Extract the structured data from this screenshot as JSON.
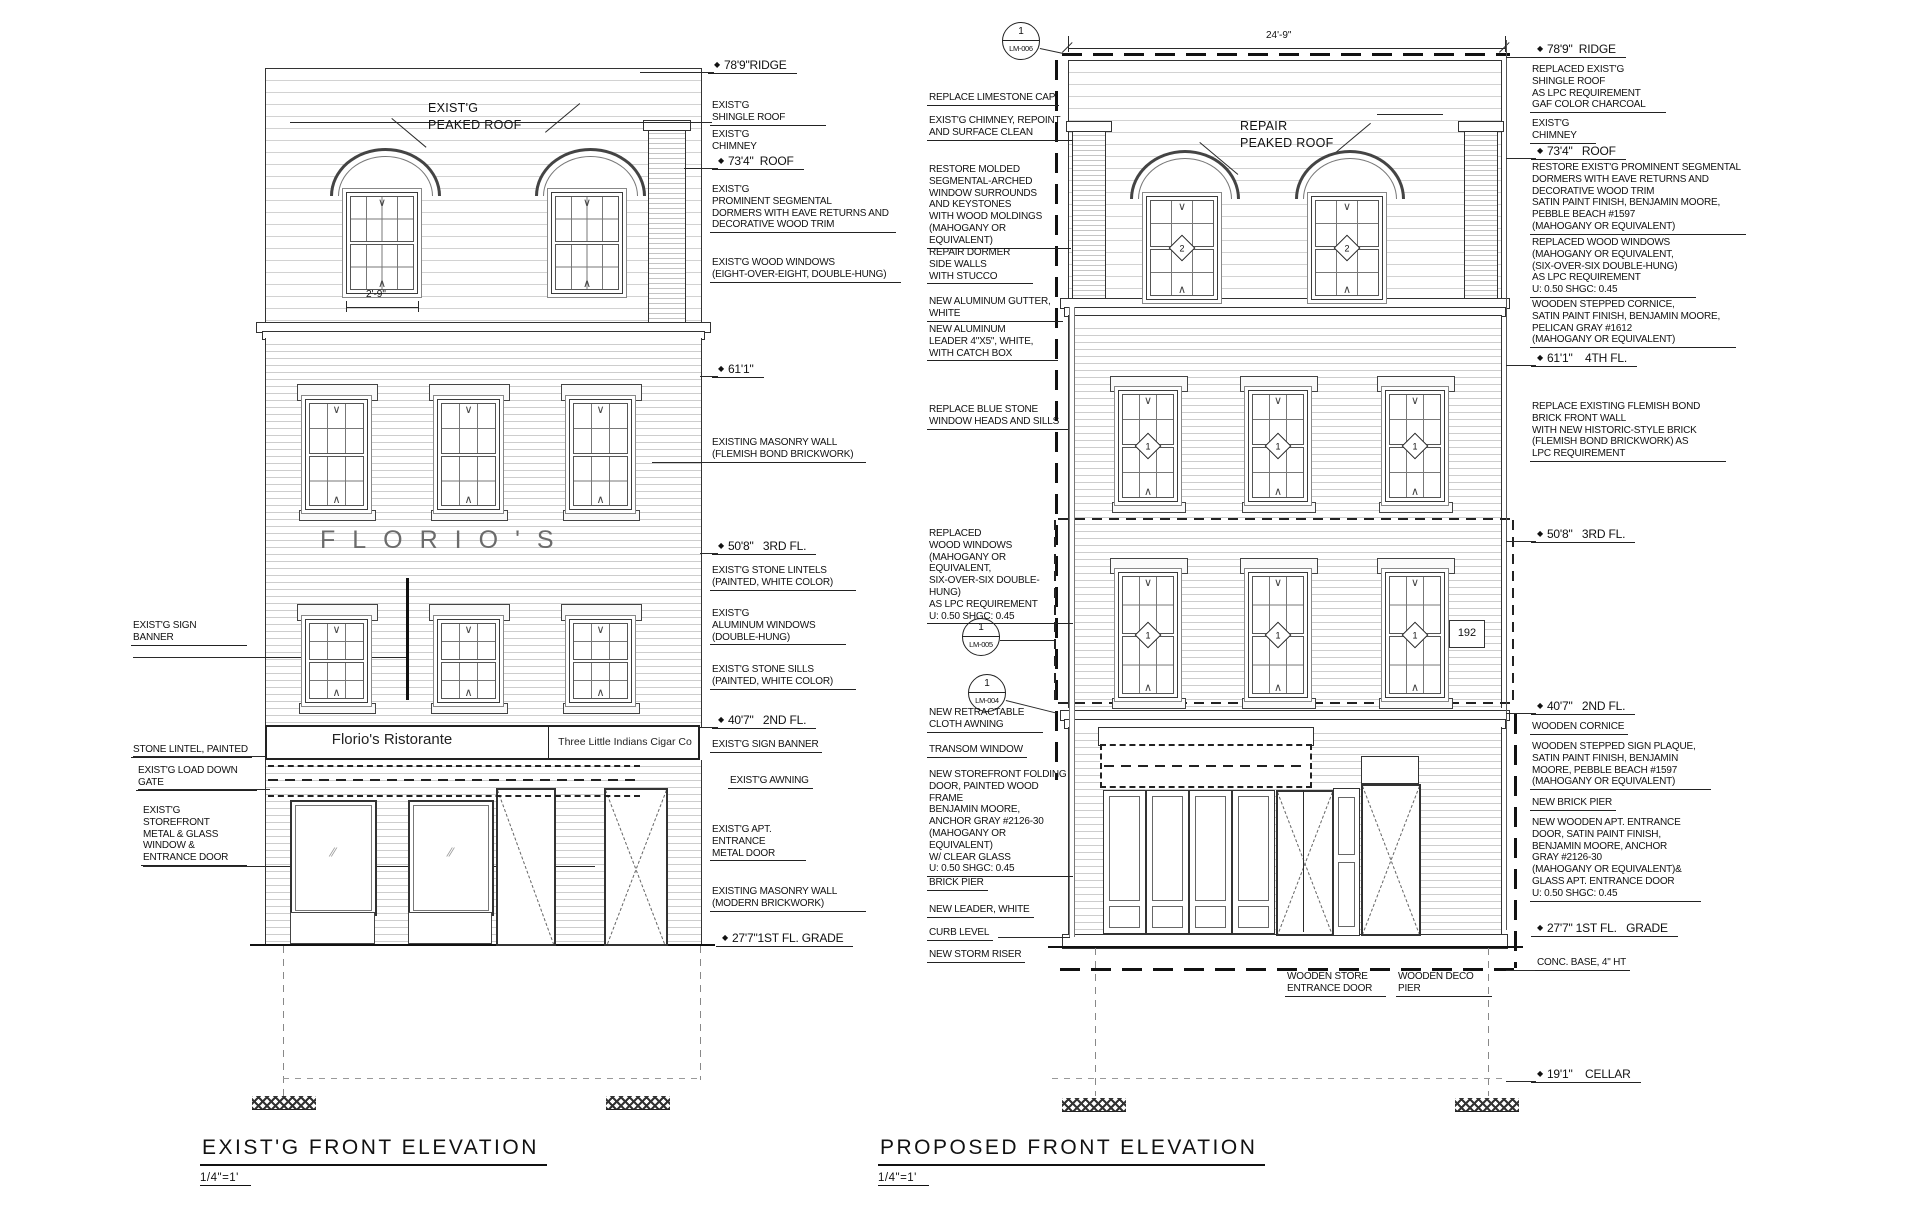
{
  "existing": {
    "title": "EXIST'G FRONT ELEVATION",
    "scale": "1/4\"=1'",
    "roof_label": "EXIST'G\nPEAKED ROOF",
    "dormer_dim": "2'-9\"",
    "facade_name": "FLORIO'S",
    "sign_left": "Florio's Ristorante",
    "sign_right": "Three Little Indians Cigar Co"
  },
  "proposed": {
    "title": "PROPOSED FRONT ELEVATION",
    "scale": "1/4\"=1'",
    "roof_label": "REPAIR\nPEAKED ROOF",
    "width_dim": "24'-9\"",
    "address": "192",
    "window_tags": {
      "dormer": "2",
      "floor": "1"
    },
    "detail_markers": [
      {
        "num": "1",
        "ref": "LM-006"
      },
      {
        "num": "1",
        "ref": "LM-005"
      },
      {
        "num": "1",
        "ref": "LM-004"
      }
    ]
  },
  "annotations": [
    {
      "t": "78'9\"RIDGE",
      "x": 714,
      "y": 58,
      "cls": "dim ul"
    },
    {
      "t": "EXIST'G\nSHINGLE ROOF",
      "x": 712,
      "y": 100,
      "cls": "ul",
      "w": 110
    },
    {
      "t": "EXIST'G\nCHIMNEY",
      "x": 712,
      "y": 129,
      "cls": ""
    },
    {
      "t": "73'4\"  ROOF",
      "x": 718,
      "y": 154,
      "cls": "dim ul"
    },
    {
      "t": "EXIST'G\nPROMINENT SEGMENTAL\nDORMERS WITH EAVE RETURNS AND\nDECORATIVE WOOD TRIM",
      "x": 712,
      "y": 184,
      "cls": "ul",
      "w": 180
    },
    {
      "t": "EXIST'G WOOD WINDOWS\n(EIGHT-OVER-EIGHT, DOUBLE-HUNG)",
      "x": 712,
      "y": 257,
      "cls": "ul",
      "w": 185
    },
    {
      "t": "61'1\"",
      "x": 718,
      "y": 362,
      "cls": "dim ul"
    },
    {
      "t": "EXISTING MASONRY WALL\n(FLEMISH BOND BRICKWORK)",
      "x": 712,
      "y": 437,
      "cls": "ul",
      "w": 150
    },
    {
      "t": "50'8\"   3RD FL.",
      "x": 718,
      "y": 539,
      "cls": "dim ul"
    },
    {
      "t": "EXIST'G STONE LINTELS\n(PAINTED, WHITE COLOR)",
      "x": 712,
      "y": 565,
      "cls": "ul",
      "w": 140
    },
    {
      "t": "EXIST'G\nALUMINUM WINDOWS\n(DOUBLE-HUNG)",
      "x": 712,
      "y": 608,
      "cls": "ul",
      "w": 130
    },
    {
      "t": "EXIST'G STONE SILLS\n(PAINTED, WHITE COLOR)",
      "x": 712,
      "y": 664,
      "cls": "ul",
      "w": 140
    },
    {
      "t": "40'7\"   2ND FL.",
      "x": 718,
      "y": 713,
      "cls": "dim ul"
    },
    {
      "t": "EXIST'G SIGN BANNER",
      "x": 712,
      "y": 739,
      "cls": "ul"
    },
    {
      "t": "EXIST'G AWNING",
      "x": 730,
      "y": 775,
      "cls": "ul"
    },
    {
      "t": "EXIST'G APT.\nENTRANCE\nMETAL DOOR",
      "x": 712,
      "y": 824,
      "cls": "ul",
      "w": 90
    },
    {
      "t": "EXISTING MASONRY WALL\n(MODERN BRICKWORK)",
      "x": 712,
      "y": 886,
      "cls": "ul",
      "w": 150
    },
    {
      "t": "27'7\"1ST FL. GRADE",
      "x": 722,
      "y": 931,
      "cls": "dim ul"
    },
    {
      "t": "EXIST'G SIGN\nBANNER",
      "x": 133,
      "y": 620,
      "cls": "ul",
      "w": 110
    },
    {
      "t": "STONE LINTEL, PAINTED",
      "x": 133,
      "y": 744,
      "cls": "ul"
    },
    {
      "t": "EXIST'G LOAD DOWN\nGATE",
      "x": 138,
      "y": 765,
      "cls": "ul",
      "w": 115
    },
    {
      "t": "EXIST'G\nSTOREFRONT\nMETAL & GLASS\nWINDOW &\nENTRANCE DOOR",
      "x": 143,
      "y": 805,
      "cls": "ul",
      "w": 100
    },
    {
      "t": "REPLACE LIMESTONE CAP",
      "x": 929,
      "y": 92,
      "cls": "ul"
    },
    {
      "t": "EXIST'G CHIMNEY, REPOINT\nAND SURFACE CLEAN",
      "x": 929,
      "y": 115,
      "cls": "ul",
      "w": 140
    },
    {
      "t": "RESTORE MOLDED\nSEGMENTAL-ARCHED\nWINDOW SURROUNDS\nAND KEYSTONES\nWITH WOOD MOLDINGS\n(MAHOGANY OR EQUIVALENT)",
      "x": 929,
      "y": 164,
      "cls": "ul",
      "w": 138
    },
    {
      "t": "REPAIR DORMER\nSIDE WALLS\nWITH STUCCO",
      "x": 929,
      "y": 247,
      "cls": "ul",
      "w": 100
    },
    {
      "t": "NEW ALUMINUM GUTTER,\nWHITE",
      "x": 929,
      "y": 296,
      "cls": "ul",
      "w": 130
    },
    {
      "t": "NEW ALUMINUM\nLEADER 4\"X5\", WHITE,\nWITH CATCH BOX",
      "x": 929,
      "y": 324,
      "cls": "ul",
      "w": 125
    },
    {
      "t": "REPLACE BLUE STONE\nWINDOW HEADS AND SILLS",
      "x": 929,
      "y": 404,
      "cls": "ul",
      "w": 135
    },
    {
      "t": "REPLACED\nWOOD WINDOWS\n(MAHOGANY OR EQUIVALENT,\nSIX-OVER-SIX DOUBLE-HUNG)\nAS LPC REQUIREMENT\nU: 0.50  SHGC: 0.45",
      "x": 929,
      "y": 528,
      "cls": "ul",
      "w": 140
    },
    {
      "t": "NEW RETRACTABLE\nCLOTH AWNING",
      "x": 929,
      "y": 707,
      "cls": "ul",
      "w": 110
    },
    {
      "t": "TRANSOM WINDOW",
      "x": 929,
      "y": 744,
      "cls": "ul"
    },
    {
      "t": "NEW STOREFRONT FOLDING\nDOOR, PAINTED WOOD FRAME\nBENJAMIN MOORE,\nANCHOR GRAY #2126-30\n(MAHOGANY OR EQUIVALENT)\nW/ CLEAR GLASS\nU: 0.50  SHGC: 0.45",
      "x": 929,
      "y": 769,
      "cls": "ul",
      "w": 140
    },
    {
      "t": "BRICK PIER",
      "x": 929,
      "y": 877,
      "cls": "ul"
    },
    {
      "t": "NEW LEADER, WHITE",
      "x": 929,
      "y": 904,
      "cls": "ul"
    },
    {
      "t": "CURB LEVEL",
      "x": 929,
      "y": 927,
      "cls": "ul"
    },
    {
      "t": "NEW STORM RISER",
      "x": 929,
      "y": 949,
      "cls": "ul"
    },
    {
      "t": "78'9\"  RIDGE",
      "x": 1537,
      "y": 42,
      "cls": "dim ul"
    },
    {
      "t": "REPLACED EXIST'G\nSHINGLE ROOF\nAS LPC REQUIREMENT\nGAF COLOR CHARCOAL",
      "x": 1532,
      "y": 64,
      "cls": "ul",
      "w": 130
    },
    {
      "t": "EXIST'G\nCHIMNEY",
      "x": 1532,
      "y": 118,
      "cls": "ul",
      "w": 60
    },
    {
      "t": "73'4\"   ROOF",
      "x": 1537,
      "y": 144,
      "cls": "dim ul"
    },
    {
      "t": "RESTORE EXIST'G PROMINENT SEGMENTAL\nDORMERS WITH EAVE RETURNS AND\nDECORATIVE WOOD TRIM\nSATIN PAINT FINISH, BENJAMIN MOORE,\nPEBBLE BEACH #1597\n(MAHOGANY OR EQUIVALENT)",
      "x": 1532,
      "y": 162,
      "cls": "ul",
      "w": 210
    },
    {
      "t": "REPLACED WOOD WINDOWS\n(MAHOGANY OR EQUIVALENT,\n(SIX-OVER-SIX DOUBLE-HUNG)\nAS LPC REQUIREMENT\nU: 0.50  SHGC: 0.45",
      "x": 1532,
      "y": 237,
      "cls": "ul",
      "w": 160
    },
    {
      "t": "WOODEN STEPPED CORNICE,\nSATIN PAINT FINISH, BENJAMIN MOORE,\nPELICAN GRAY #1612\n(MAHOGANY OR EQUIVALENT)",
      "x": 1532,
      "y": 299,
      "cls": "ul",
      "w": 200
    },
    {
      "t": "61'1\"    4TH FL.",
      "x": 1537,
      "y": 351,
      "cls": "dim ul"
    },
    {
      "t": "REPLACE EXISTING FLEMISH BOND\nBRICK FRONT WALL\nWITH NEW HISTORIC-STYLE BRICK\n(FLEMISH BOND BRICKWORK) AS\nLPC REQUIREMENT",
      "x": 1532,
      "y": 401,
      "cls": "ul",
      "w": 190
    },
    {
      "t": "50'8\"   3RD FL.",
      "x": 1537,
      "y": 527,
      "cls": "dim ul"
    },
    {
      "t": "40'7\"   2ND FL.",
      "x": 1537,
      "y": 699,
      "cls": "dim ul"
    },
    {
      "t": "WOODEN CORNICE",
      "x": 1532,
      "y": 721,
      "cls": "ul"
    },
    {
      "t": "WOODEN STEPPED SIGN PLAQUE,\nSATIN PAINT FINISH, BENJAMIN\nMOORE, PEBBLE BEACH #1597\n(MAHOGANY OR EQUIVALENT)",
      "x": 1532,
      "y": 741,
      "cls": "ul",
      "w": 175
    },
    {
      "t": "NEW BRICK PIER",
      "x": 1532,
      "y": 797,
      "cls": "ul"
    },
    {
      "t": "NEW WOODEN APT. ENTRANCE\nDOOR, SATIN PAINT FINISH,\nBENJAMIN MOORE, ANCHOR\nGRAY #2126-30\n(MAHOGANY OR EQUIVALENT)&\nGLASS APT. ENTRANCE DOOR\nU: 0.50  SHGC: 0.45",
      "x": 1532,
      "y": 817,
      "cls": "ul",
      "w": 165
    },
    {
      "t": "27'7\" 1ST FL.   GRADE",
      "x": 1537,
      "y": 921,
      "cls": "dim ul"
    },
    {
      "t": "CONC. BASE, 4\" HT",
      "x": 1537,
      "y": 957,
      "cls": "ul"
    },
    {
      "t": "19'1\"    CELLAR",
      "x": 1537,
      "y": 1067,
      "cls": "dim ul"
    },
    {
      "t": "WOODEN STORE\nENTRANCE DOOR",
      "x": 1287,
      "y": 971,
      "cls": "ul",
      "w": 95
    },
    {
      "t": "WOODEN DECO\nPIER",
      "x": 1398,
      "y": 971,
      "cls": "ul",
      "w": 90
    }
  ]
}
